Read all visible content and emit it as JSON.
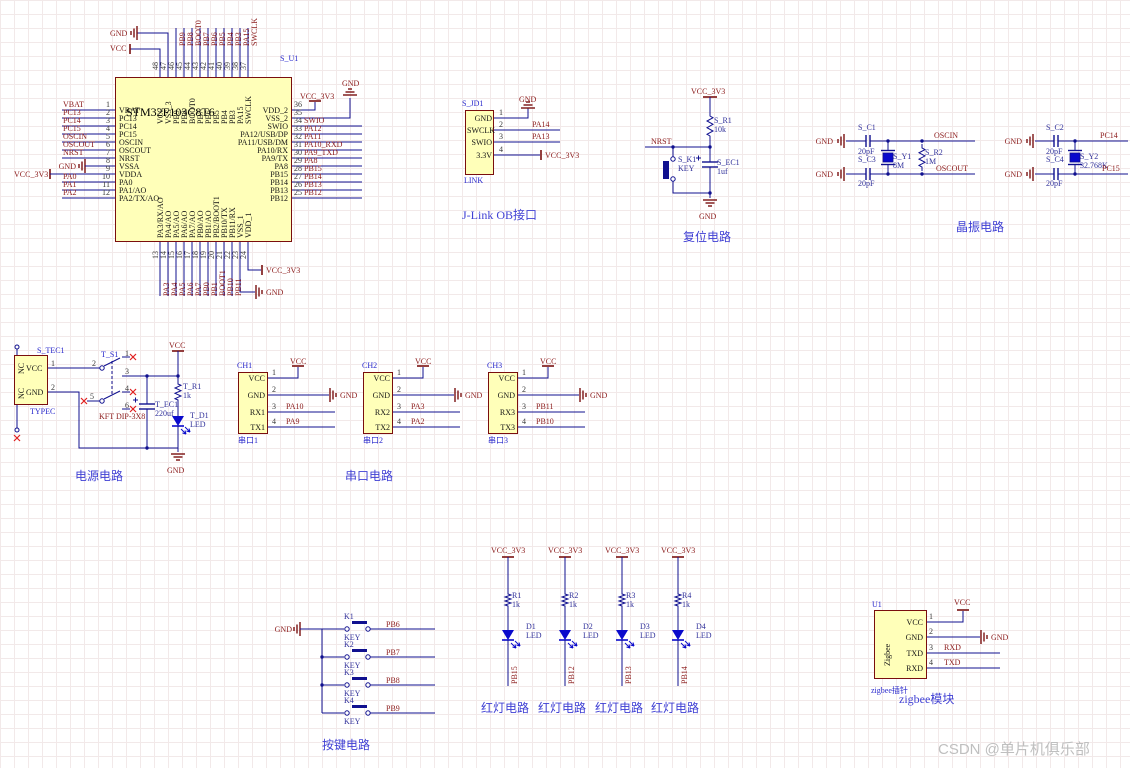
{
  "watermark": "CSDN @单片机俱乐部",
  "colors": {
    "wire": "#10108F",
    "symbol": "#7A1010",
    "net": "#8B1A1A",
    "designator": "#2929CC",
    "value": "#32329B",
    "led": "#0A0ACC",
    "xmark": "#E02020",
    "component_fill": "#FFFFB9",
    "component_border": "#7A0E0E",
    "watermark": "#BFBFBF"
  },
  "mcu": {
    "designator": "S_U1",
    "name": "STM32F103C8T6",
    "top_power": {
      "gnd": "GND",
      "vcc": "VCC"
    },
    "top_pins": [
      {
        "num": "48",
        "name": "VCC"
      },
      {
        "num": "47",
        "name": "VSS_3"
      },
      {
        "num": "46",
        "name": "PB9",
        "net": "PB9"
      },
      {
        "num": "45",
        "name": "PB8",
        "net": "PB8"
      },
      {
        "num": "44",
        "name": "BOOT0",
        "net": "BOOT0"
      },
      {
        "num": "43",
        "name": "PB7",
        "net": "PB7"
      },
      {
        "num": "42",
        "name": "PB6",
        "net": "PB6"
      },
      {
        "num": "41",
        "name": "PB5",
        "net": "PB5"
      },
      {
        "num": "40",
        "name": "PB4",
        "net": "PB4"
      },
      {
        "num": "39",
        "name": "PB3",
        "net": "PB3"
      },
      {
        "num": "38",
        "name": "PA15",
        "net": "PA15"
      },
      {
        "num": "37",
        "name": "SWCLK",
        "net": "SWCLK"
      }
    ],
    "left_pins": [
      {
        "num": "1",
        "name": "VBAT",
        "net": "VBAT"
      },
      {
        "num": "2",
        "name": "PC13",
        "net": "PC13"
      },
      {
        "num": "3",
        "name": "PC14",
        "net": "PC14"
      },
      {
        "num": "4",
        "name": "PC15",
        "net": "PC15"
      },
      {
        "num": "5",
        "name": "OSCIN",
        "net": "OSCIN"
      },
      {
        "num": "6",
        "name": "OSCOUT",
        "net": "OSCOUT"
      },
      {
        "num": "7",
        "name": "NRST",
        "net": "NRST"
      },
      {
        "num": "8",
        "name": "VSSA",
        "net": "GND"
      },
      {
        "num": "9",
        "name": "VDDA",
        "net": "VCC_3V3"
      },
      {
        "num": "10",
        "name": "PA0",
        "net": "PA0"
      },
      {
        "num": "11",
        "name": "PA1/AO",
        "net": "PA1"
      },
      {
        "num": "12",
        "name": "PA2/TX/AO",
        "net": "PA2"
      }
    ],
    "right_pins": [
      {
        "num": "36",
        "name": "VDD_2",
        "net": "VCC_3V3"
      },
      {
        "num": "35",
        "name": "VSS_2",
        "net": "GND"
      },
      {
        "num": "34",
        "name": "SWIO",
        "net": "SWIO"
      },
      {
        "num": "33",
        "name": "PA12/USB/DP",
        "net": "PA12"
      },
      {
        "num": "32",
        "name": "PA11/USB/DM",
        "net": "PA11"
      },
      {
        "num": "31",
        "name": "PA10/RX",
        "net": "PA10_RXD"
      },
      {
        "num": "30",
        "name": "PA9/TX",
        "net": "PA9_TXD"
      },
      {
        "num": "29",
        "name": "PA8",
        "net": "PA8"
      },
      {
        "num": "28",
        "name": "PB15",
        "net": "PB15"
      },
      {
        "num": "27",
        "name": "PB14",
        "net": "PB14"
      },
      {
        "num": "26",
        "name": "PB13",
        "net": "PB13"
      },
      {
        "num": "25",
        "name": "PB12",
        "net": "PB12"
      }
    ],
    "bottom_pins": [
      {
        "num": "13",
        "name": "PA3/RX/AO",
        "net": "PA3"
      },
      {
        "num": "14",
        "name": "PA4/AO",
        "net": "PA4"
      },
      {
        "num": "15",
        "name": "PA5/AO",
        "net": "PA5"
      },
      {
        "num": "16",
        "name": "PA6/AO",
        "net": "PA6"
      },
      {
        "num": "17",
        "name": "PA7/AO",
        "net": "PA7"
      },
      {
        "num": "18",
        "name": "PB0/AO",
        "net": "PB0"
      },
      {
        "num": "19",
        "name": "PB1/AO",
        "net": "PB1"
      },
      {
        "num": "20",
        "name": "PB2/BOOT1",
        "net": "BOOT1"
      },
      {
        "num": "21",
        "name": "PB10/TX",
        "net": "PB10"
      },
      {
        "num": "22",
        "name": "PB11/RX",
        "net": "PB11"
      },
      {
        "num": "23",
        "name": "VSS_1",
        "net": "GND"
      },
      {
        "num": "24",
        "name": "VDD_1",
        "net": "VCC_3V3"
      }
    ]
  },
  "jlink": {
    "ref": "S_JD1",
    "footer": "LINK",
    "title": "J-Link OB接口",
    "gnd": "GND",
    "vcc": "VCC_3V3",
    "pins": [
      {
        "num": "1",
        "name": "GND"
      },
      {
        "num": "2",
        "name": "SWCLK",
        "net": "PA14"
      },
      {
        "num": "3",
        "name": "SWIO",
        "net": "PA13"
      },
      {
        "num": "4",
        "name": "3.3V"
      }
    ]
  },
  "reset": {
    "title": "复位电路",
    "vcc": "VCC_3V3",
    "gnd": "GND",
    "net": "NRST",
    "resistor": {
      "ref": "S_R1",
      "value": "10k"
    },
    "key": {
      "ref": "S_K1",
      "value": "KEY"
    },
    "cap": {
      "ref": "S_EC1",
      "value": "1uf"
    }
  },
  "crystal": {
    "title": "晶振电路",
    "groups": [
      {
        "gnd": "GND",
        "cap_top": {
          "ref": "S_C1",
          "value": "20pF"
        },
        "cap_bottom": {
          "ref": "S_C3",
          "value": "20pF"
        },
        "crystal": {
          "ref": "S_Y1",
          "value": "8M"
        },
        "resistor": {
          "ref": "S_R2",
          "value": "1M"
        },
        "net_top": "OSCIN",
        "net_bottom": "OSCOUT"
      },
      {
        "gnd": "GND",
        "cap_top": {
          "ref": "S_C2",
          "value": "20pF"
        },
        "cap_bottom": {
          "ref": "S_C4",
          "value": "20pF"
        },
        "crystal": {
          "ref": "S_Y2",
          "value": "32.768K"
        },
        "net_top": "PC14",
        "net_bottom": "PC15"
      }
    ]
  },
  "power": {
    "title": "电源电路",
    "vcc": "VCC",
    "gnd": "GND",
    "connector": {
      "ref": "S_TEC1",
      "footer": "TYPEC",
      "nc": "NC",
      "pins": [
        {
          "num": "1",
          "name": "VCC"
        },
        {
          "num": "2",
          "name": "GND"
        }
      ]
    },
    "switch": {
      "ref": "T_S1",
      "comment": "KFT DIP-3X8",
      "pin_numbers": [
        "1",
        "2",
        "3",
        "4",
        "5",
        "6"
      ]
    },
    "resistor": {
      "ref": "T_R1",
      "value": "1k"
    },
    "cap": {
      "ref": "T_EC1",
      "value": "220uf"
    },
    "led": {
      "ref": "T_D1",
      "value": "LED"
    }
  },
  "serial": {
    "title": "串口电路",
    "ports": [
      {
        "header": "CH1",
        "caption": "串口1",
        "vcc": "VCC",
        "gnd": "GND",
        "pins": [
          {
            "num": "1",
            "name": "VCC"
          },
          {
            "num": "2",
            "name": "GND"
          },
          {
            "num": "3",
            "name": "RX1",
            "net": "PA10"
          },
          {
            "num": "4",
            "name": "TX1",
            "net": "PA9"
          }
        ]
      },
      {
        "header": "CH2",
        "caption": "串口2",
        "vcc": "VCC",
        "gnd": "GND",
        "pins": [
          {
            "num": "1",
            "name": "VCC"
          },
          {
            "num": "2",
            "name": "GND"
          },
          {
            "num": "3",
            "name": "RX2",
            "net": "PA3"
          },
          {
            "num": "4",
            "name": "TX2",
            "net": "PA2"
          }
        ]
      },
      {
        "header": "CH3",
        "caption": "串口3",
        "vcc": "VCC",
        "gnd": "GND",
        "pins": [
          {
            "num": "1",
            "name": "VCC"
          },
          {
            "num": "2",
            "name": "GND"
          },
          {
            "num": "3",
            "name": "RX3",
            "net": "PB11"
          },
          {
            "num": "4",
            "name": "TX3",
            "net": "PB10"
          }
        ]
      }
    ]
  },
  "buttons": {
    "title": "按键电路",
    "gnd": "GND",
    "keys": [
      {
        "ref": "K1",
        "comment": "KEY",
        "net": "PB6"
      },
      {
        "ref": "K2",
        "comment": "KEY",
        "net": "PB7"
      },
      {
        "ref": "K3",
        "comment": "KEY",
        "net": "PB8"
      },
      {
        "ref": "K4",
        "comment": "KEY",
        "net": "PB9"
      }
    ]
  },
  "leds": {
    "caption": "红灯电路",
    "branches": [
      {
        "power": "VCC_3V3",
        "res_ref": "R1",
        "res_value": "1k",
        "led_ref": "D1",
        "led_value": "LED",
        "net": "PB15"
      },
      {
        "power": "VCC_3V3",
        "res_ref": "R2",
        "res_value": "1k",
        "led_ref": "D2",
        "led_value": "LED",
        "net": "PB12"
      },
      {
        "power": "VCC_3V3",
        "res_ref": "R3",
        "res_value": "1k",
        "led_ref": "D3",
        "led_value": "LED",
        "net": "PB13"
      },
      {
        "power": "VCC_3V3",
        "res_ref": "R4",
        "res_value": "1k",
        "led_ref": "D4",
        "led_value": "LED",
        "net": "PB14"
      }
    ]
  },
  "zigbee": {
    "ref": "U1",
    "body": "Zigbee",
    "footer": "zigbee插针",
    "title": "zigbee模块",
    "vcc": "VCC",
    "gnd": "GND",
    "pins": [
      {
        "num": "1",
        "name": "VCC"
      },
      {
        "num": "2",
        "name": "GND"
      },
      {
        "num": "3",
        "name": "TXD",
        "net": "RXD"
      },
      {
        "num": "4",
        "name": "RXD",
        "net": "TXD"
      }
    ]
  }
}
